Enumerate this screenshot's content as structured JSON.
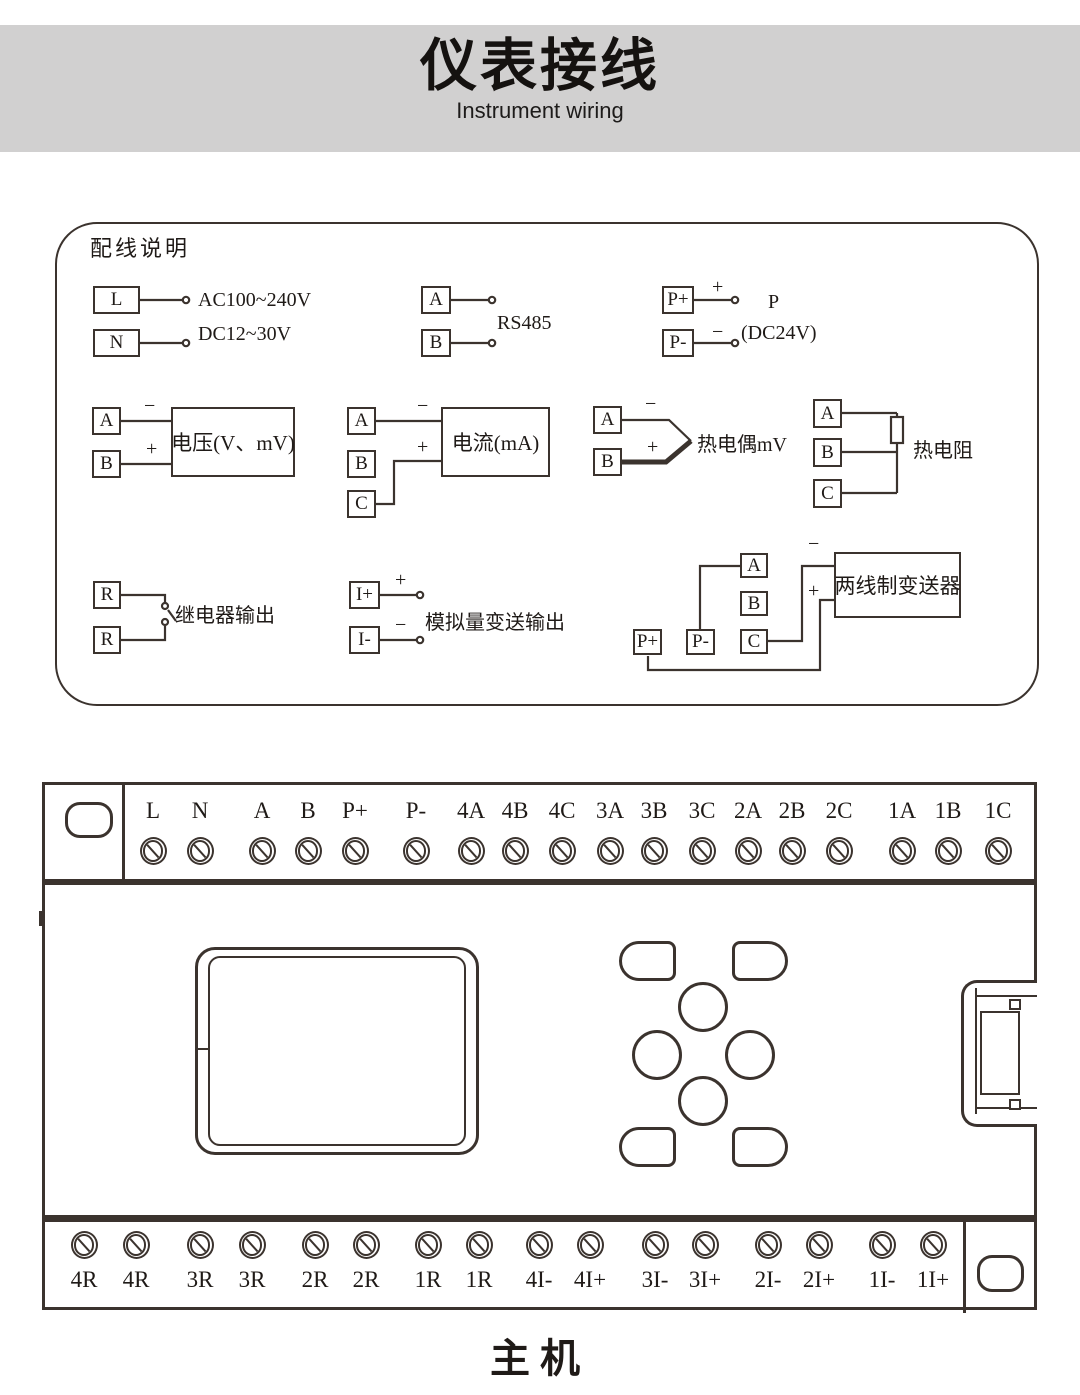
{
  "colors": {
    "line": "#3b332e",
    "ink": "#1f1a17",
    "band": "#d1d0d0"
  },
  "header": {
    "title": "仪表接线",
    "subtitle": "Instrument wiring"
  },
  "wiring_panel": {
    "title": "配线说明",
    "power": {
      "t1": "L",
      "t2": "N",
      "desc1": "AC100~240V",
      "desc2": "DC12~30V"
    },
    "rs485": {
      "t1": "A",
      "t2": "B",
      "label": "RS485"
    },
    "p24": {
      "t1": "P+",
      "t2": "P-",
      "plus": "+",
      "minus": "−",
      "name": "P",
      "desc": "(DC24V)"
    },
    "voltage": {
      "t1": "A",
      "t2": "B",
      "minus": "−",
      "plus": "+",
      "label": "电压(V、mV)"
    },
    "current": {
      "t1": "A",
      "t2": "B",
      "t3": "C",
      "minus": "−",
      "plus": "+",
      "label": "电流(mA)"
    },
    "thermocouple": {
      "t1": "A",
      "t2": "B",
      "minus": "−",
      "plus": "+",
      "label": "热电偶mV"
    },
    "rtd": {
      "t1": "A",
      "t2": "B",
      "t3": "C",
      "label": "热电阻"
    },
    "relay": {
      "t1": "R",
      "t2": "R",
      "label": "继电器输出"
    },
    "analog_out": {
      "t1": "I+",
      "t2": "I-",
      "plus": "+",
      "minus": "−",
      "label": "模拟量变送输出"
    },
    "transmitter": {
      "t1": "A",
      "t2": "B",
      "t3": "C",
      "t4": "P+",
      "t5": "P-",
      "minus": "−",
      "plus": "+",
      "label": "两线制变送器"
    }
  },
  "main_unit": {
    "top_terminals": [
      "L",
      "N",
      "A",
      "B",
      "P+",
      "P-",
      "4A",
      "4B",
      "4C",
      "3A",
      "3B",
      "3C",
      "2A",
      "2B",
      "2C",
      "1A",
      "1B",
      "1C"
    ],
    "bottom_terminals": [
      "4R",
      "4R",
      "3R",
      "3R",
      "2R",
      "2R",
      "1R",
      "1R",
      "4I-",
      "4I+",
      "3I-",
      "3I+",
      "2I-",
      "2I+",
      "1I-",
      "1I+"
    ],
    "caption": "主机"
  }
}
